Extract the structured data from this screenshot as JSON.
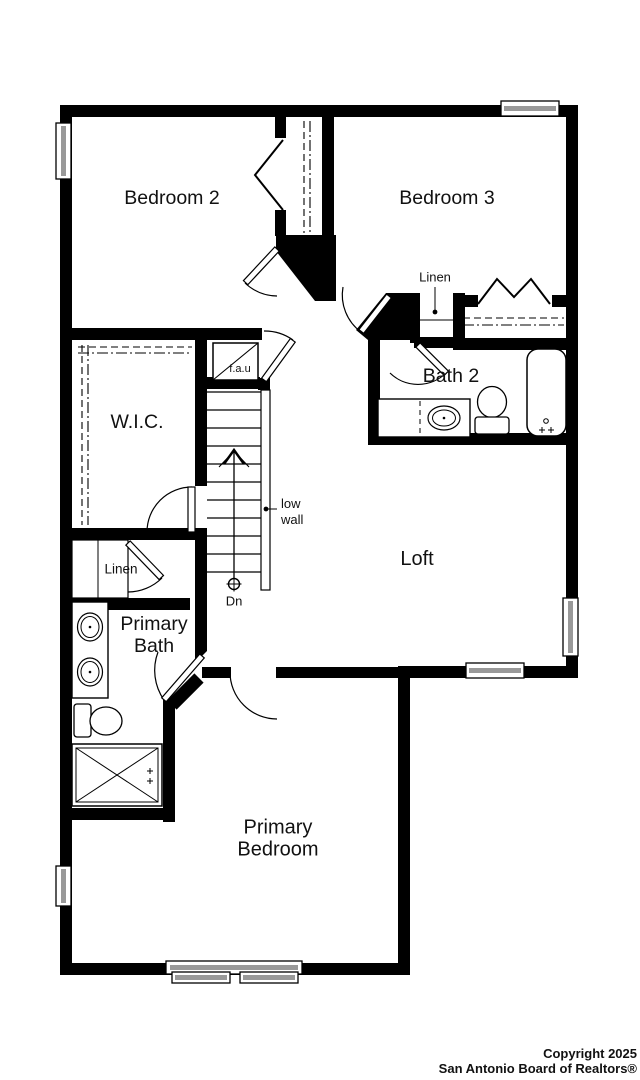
{
  "plan": {
    "rooms": {
      "bedroom2": "Bedroom 2",
      "bedroom3": "Bedroom 3",
      "bath2": "Bath 2",
      "wic": "W.I.C.",
      "loft": "Loft",
      "linen_upper": "Linen",
      "linen_lower": "Linen",
      "primary_bath": "Primary Bath",
      "primary_bedroom": "Primary Bedroom"
    },
    "annotations": {
      "fau": "f.a.u",
      "low_wall": "low wall",
      "down": "Dn"
    },
    "colors": {
      "wall": "#000000",
      "window_glass": "#999999",
      "background": "#ffffff"
    }
  },
  "footer": {
    "copyright_line1": "Copyright 2025",
    "copyright_line2": "San Antonio Board of Realtors®"
  }
}
